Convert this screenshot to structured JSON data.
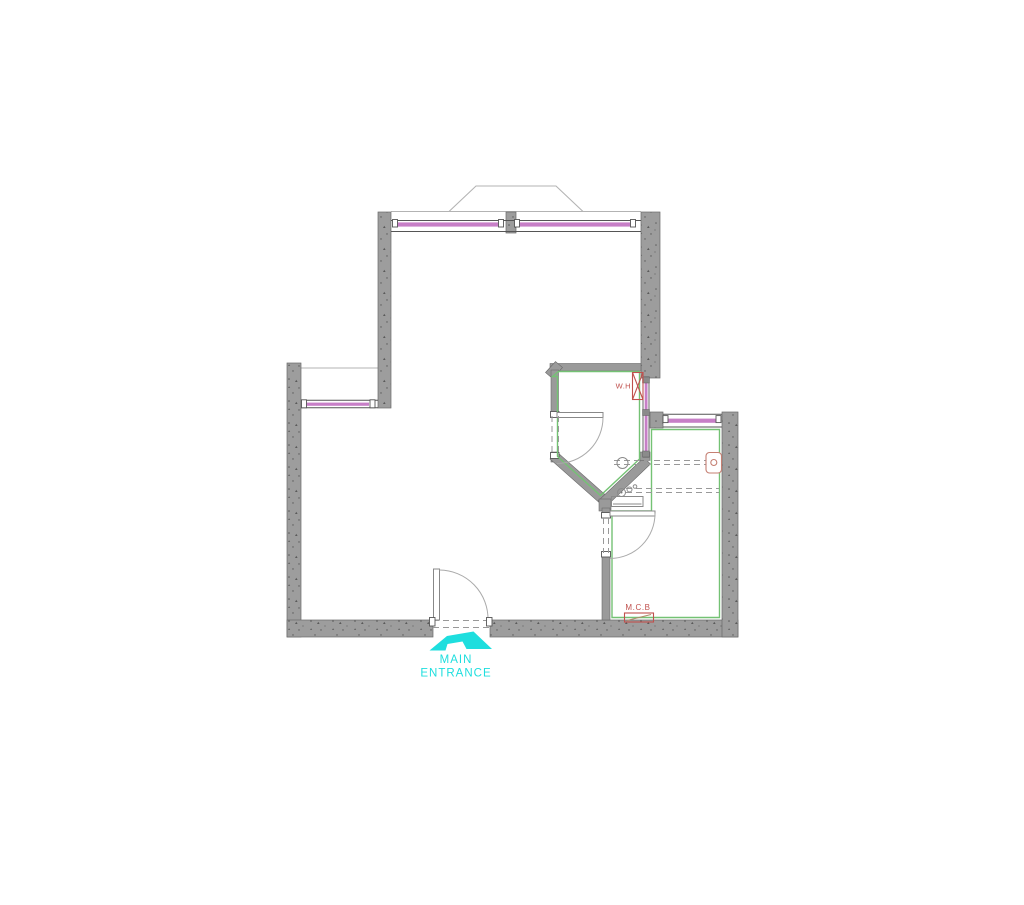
{
  "labels": {
    "water_heater": "W.H",
    "main_circuit_board": "M.C.B",
    "main_entrance_line1": "MAIN",
    "main_entrance_line2": "ENTRANCE"
  },
  "colors": {
    "wall_gray": "#9d9d9d",
    "wall_edge": "#6a6a6a",
    "window_purple": "#c77fc7",
    "room_outline_green": "#74c274",
    "annotation_red": "#c0504d",
    "entrance_cyan": "#1edede",
    "line_gray": "#999999",
    "projection_gray": "#b3b3b3"
  },
  "icons": {
    "entrance_arrow": "main-entrance-arrow-icon",
    "water_heater_symbol": "water-heater-x-box",
    "toilet_symbol": "toilet-cistern",
    "mcb_symbol": "mcb-box"
  }
}
